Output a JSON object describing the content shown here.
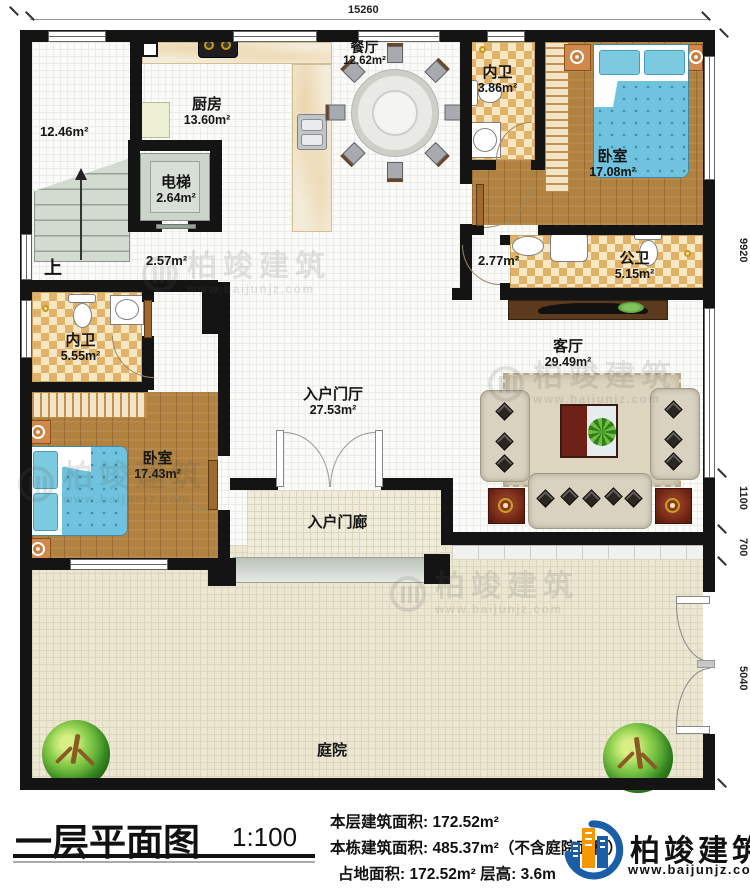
{
  "plan": {
    "dim_top": "15260",
    "dim_right": {
      "a": "9920",
      "b": "1100",
      "c": "700",
      "d": "5040"
    },
    "rooms": {
      "stairhall": {
        "area": "12.46m²",
        "up": "上"
      },
      "kitchen": {
        "name": "厨房",
        "area": "13.60m²"
      },
      "dining": {
        "name": "餐厅",
        "area": "12.62m²"
      },
      "elevator": {
        "name": "电梯",
        "area": "2.64m²"
      },
      "bath_top": {
        "name": "内卫",
        "area": "3.86m²"
      },
      "bedroom_right": {
        "name": "卧室",
        "area": "17.08m²"
      },
      "public_bath": {
        "name": "公卫",
        "area": "5.15m²"
      },
      "hall_mid": {
        "area": "2.57m²"
      },
      "hall_right": {
        "area": "2.77m²"
      },
      "bath_left": {
        "name": "内卫",
        "area": "5.55m²"
      },
      "bedroom_left": {
        "name": "卧室",
        "area": "17.43m²"
      },
      "foyer": {
        "name": "入户门厅",
        "area": "27.53m²"
      },
      "living": {
        "name": "客厅",
        "area": "29.49m²"
      },
      "porch": {
        "name": "入户门廊"
      },
      "courtyard": {
        "name": "庭院"
      }
    }
  },
  "watermark": {
    "brand": "柏竣建筑",
    "url": "www.baijunjz.com"
  },
  "title_block": {
    "title": "一层平面图",
    "scale": "1:100",
    "line1": "本层建筑面积: 172.52m²",
    "line2": "本栋建筑面积: 485.37m²（不含庭院面积）",
    "line3": "占地面积: 172.52m²  层高: 3.6m"
  },
  "logo": {
    "brand": "柏竣建筑",
    "url": "www.baijunjz.com"
  },
  "colors": {
    "wall": "#141414",
    "wood": "#b0813f",
    "tile_tan": "#e3b269",
    "bed_blue": "#6fc3de",
    "logo_blue": "#1b5ea8",
    "logo_orange": "#f39800"
  }
}
